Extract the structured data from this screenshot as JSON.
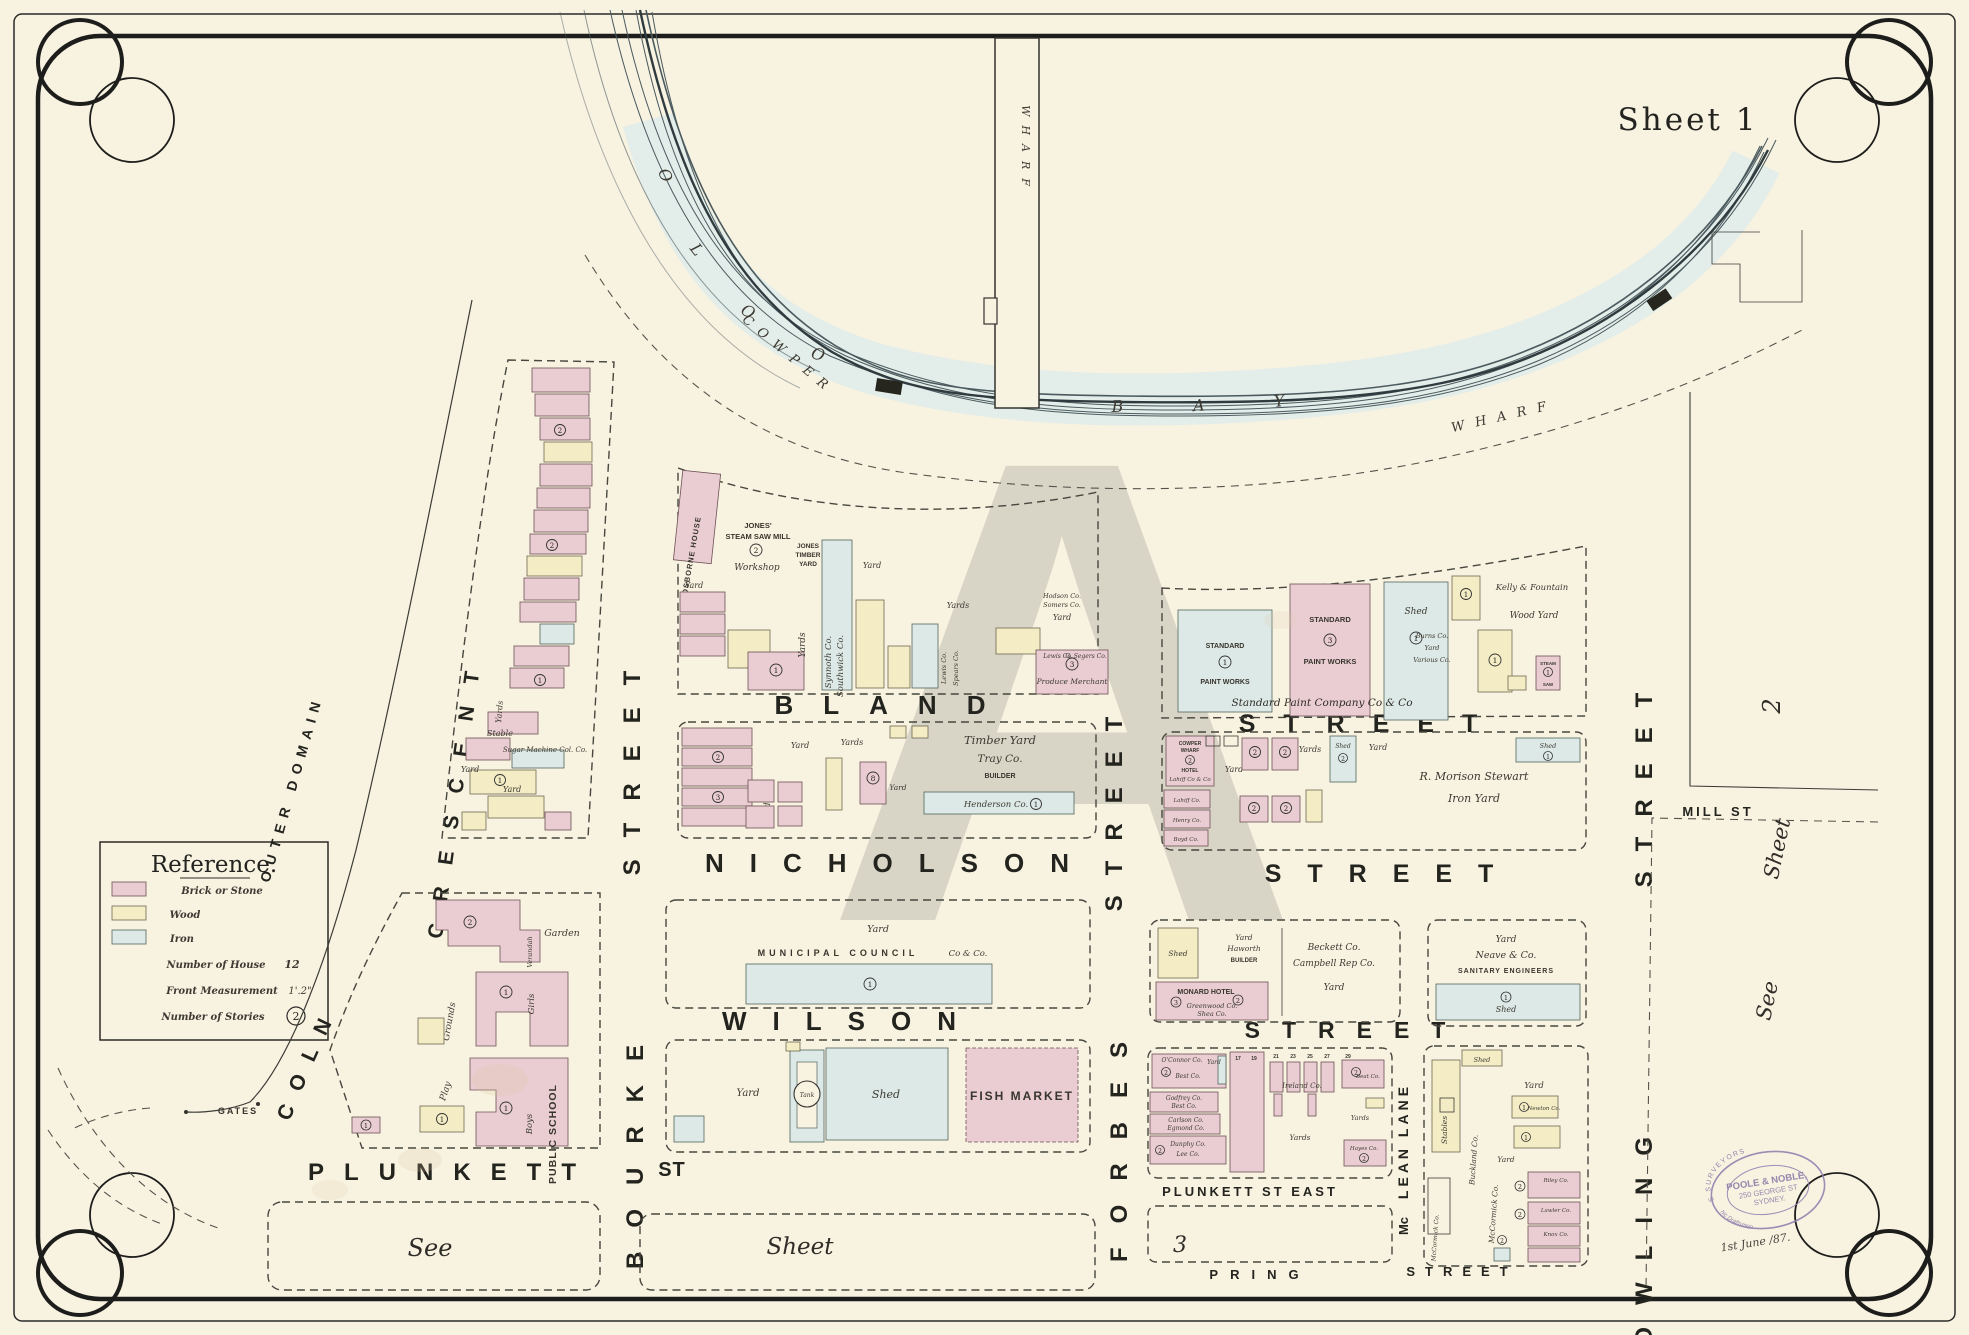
{
  "sheet": {
    "label": "Sheet 1"
  },
  "watermark": "A",
  "reference": {
    "title": "Reference.",
    "brick": "Brick or Stone",
    "wood": "Wood",
    "iron": "Iron",
    "house": "Number of House",
    "house_num": "12",
    "front": "Front Measurement",
    "front_val": "1'.2\"",
    "stories": "Number of Stories",
    "stories_val": "2"
  },
  "water": {
    "bay_name": "WOOLLOOMOOLOO BAY",
    "pier": "WHARF",
    "cowper": "COWPER",
    "wharf_road": "WHARF"
  },
  "streets": {
    "bland": "BLAND",
    "street_bland": "STREET",
    "nicholson": "NICHOLSON",
    "street_nicholson": "STREET",
    "wilson": "WILSON",
    "street_wilson": "STREET",
    "plunkett": "PLUNKETT",
    "st_abbr": "ST",
    "plunkett_east": "PLUNKETT  ST  EAST",
    "pring": "PRING",
    "street_pring": "STREET",
    "bourke": "BOURKE",
    "street_bourke": "STREET",
    "forbes": "FORBES",
    "street_forbes": "STREET",
    "dowling": "DOWLING",
    "street_dowling": "STREET",
    "lincoln": "LINCOLN",
    "crescent": "CRESCENT",
    "mclean_mc": "Mc",
    "mclean_lean": "LEAN",
    "mclean_lane": "LANE",
    "mill": "MILL  ST",
    "outer_domain": "OUTER   DOMAIN",
    "gates": "GATES"
  },
  "refs": {
    "see_w": "See",
    "sheet_w": "Sheet",
    "three": "3",
    "see_e": "See",
    "sheet_e": "Sheet",
    "two": "2"
  },
  "badges": {
    "1": "1",
    "2": "2",
    "3": "3",
    "8": "8"
  },
  "stamp": {
    "top": "ARCHITECTS  SURVEYORS",
    "bottom": "& Lithographic Draftsmen",
    "name": "POOLE & NOBLE,",
    "addr": "250 GEORGE ST",
    "city": "SYDNEY.",
    "date": "1st June /87."
  },
  "blocks": {
    "yards": {
      "yard": "Yard",
      "yards": "Yards",
      "shed": "Shed"
    },
    "crescent_block": {
      "stable": "Stable",
      "sugar": "Sugar Machine Col. Co."
    },
    "jones": {
      "osborne": "OSBORNE HOUSE",
      "jones1": "JONES'",
      "jones2": "STEAM SAW MILL",
      "workshop": "Workshop",
      "timber1": "JONES",
      "timber2": "TIMBER",
      "timber3": "YARD",
      "synnoth": "Synnoth Co.",
      "southwick": "Southwick Co.",
      "lewis": "Lewis Co.",
      "spears": "Spears Co.",
      "hodson": "Hodson Co.",
      "somers": "Somers Co.",
      "lewis2": "Lewis Co.",
      "segers": "G. Segers Co.",
      "produce": "Produce Merchant"
    },
    "standard": {
      "s1": "STANDARD",
      "s2": "PAINT WORKS",
      "script": "Standard  Paint  Company  Co & Co",
      "kelly": "Kelly & Fountain",
      "woodyard": "Wood Yard",
      "burns": "Burns Co.",
      "various": "Various Co.",
      "steam": "STEAM",
      "saw": "SAW"
    },
    "timberyard": {
      "l1": "Timber Yard",
      "l2": "Tray Co.",
      "l3": "BUILDER",
      "henderson": "Henderson Co."
    },
    "morrison": {
      "hotel1": "COWPER",
      "hotel2": "WHARF",
      "hotel3": "HOTEL",
      "lahiff": "Lahiff Co & Co",
      "lahiff2": "Lahiff Co.",
      "henry": "Henry Co.",
      "boyd": "Boyd Co.",
      "name": "R. Morison Stewart",
      "iron_yard": "Iron  Yard"
    },
    "municipal": {
      "name": "MUNICIPAL   COUNCIL",
      "co": "Co & Co."
    },
    "market": {
      "tank": "Tank",
      "fish": "FISH  MARKET"
    },
    "monard": {
      "haworth": "Haworth",
      "builder": "BUILDER",
      "hotel": "MONARD HOTEL",
      "greenwood": "Greenwood Co.",
      "shea": "Shea Co.",
      "beckett": "Beckett Co.",
      "campbell": "Campbell Rep Co."
    },
    "neave": {
      "name": "Neave & Co.",
      "sanitary": "SANITARY ENGINEERS"
    },
    "school": {
      "garden": "Garden",
      "verandah": "Verandah",
      "grounds": "Grounds",
      "play": "Play",
      "girls": "Girls",
      "boys": "Boys",
      "name": "PUBLIC SCHOOL"
    },
    "plunkett_block": {
      "oconnor": "O'Connor Co.",
      "best": "Best Co.",
      "godfrey": "Godfrey Co.",
      "carlson": "Carlson Co.",
      "egmond": "Egmond Co.",
      "dunphy": "Dunphy Co.",
      "lee": "Lee Co.",
      "ireland": "Ireland  Co.",
      "hayes": "Hayes Co.",
      "beat": "Beat Co.",
      "nums": [
        "17",
        "19",
        "21",
        "23",
        "25",
        "27",
        "29"
      ]
    },
    "mclean_block": {
      "stables": "Stables",
      "buckland": "Buckland Co.",
      "mccormick": "McCormick Co.",
      "newton": "Newton Co.",
      "riley": "Riley Co.",
      "lawler": "Lawler Co.",
      "knox": "Knox Co."
    }
  }
}
